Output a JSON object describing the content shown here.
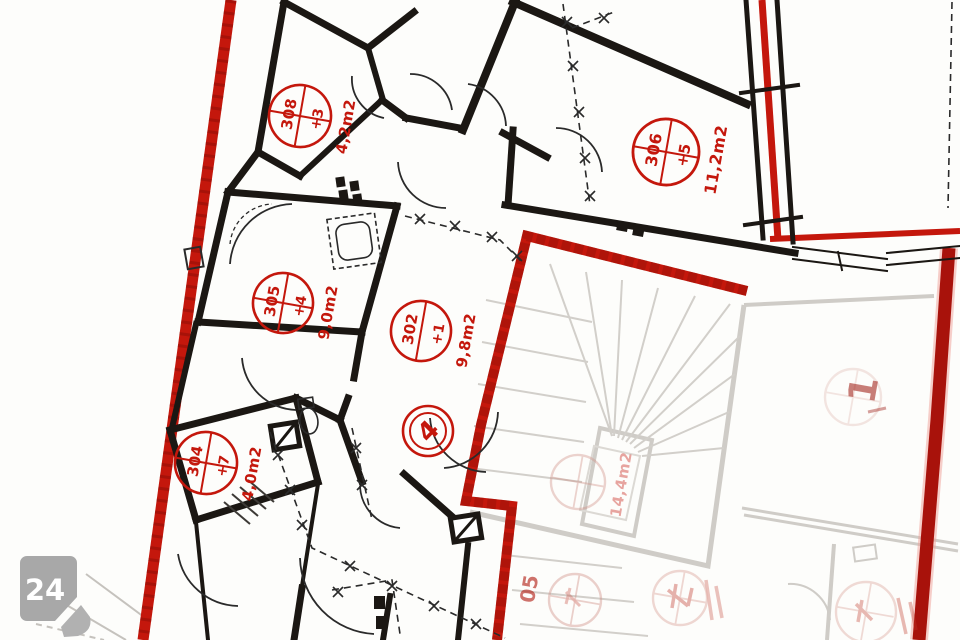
{
  "document": {
    "type": "scanned apartment floor plan, page marker bottom-left"
  },
  "badge": {
    "number": "24"
  },
  "stamps": {
    "r308": {
      "number": "308",
      "sub": "+3",
      "area": "4,2m2"
    },
    "r306": {
      "number": "306",
      "sub": "+5",
      "area": "11,2m2"
    },
    "r305": {
      "number": "305",
      "sub": "+4",
      "area": "9,0m2"
    },
    "r302": {
      "number": "302",
      "sub": "+1",
      "area": "9,8m2"
    },
    "r304": {
      "number": "304",
      "sub": "+7",
      "area": "4,0m2"
    },
    "door": {
      "number": "4"
    }
  },
  "faint": {
    "area_right": "14,4m2",
    "mark_right": "1",
    "mark_bottom": "05"
  },
  "colors": {
    "boundary_red": "#c4170c",
    "boundary_red_dark": "#8f0e08",
    "wall_black": "#1b1713",
    "faded_gray": "#cfccc7",
    "badge_gray": "#a8a8a8"
  }
}
